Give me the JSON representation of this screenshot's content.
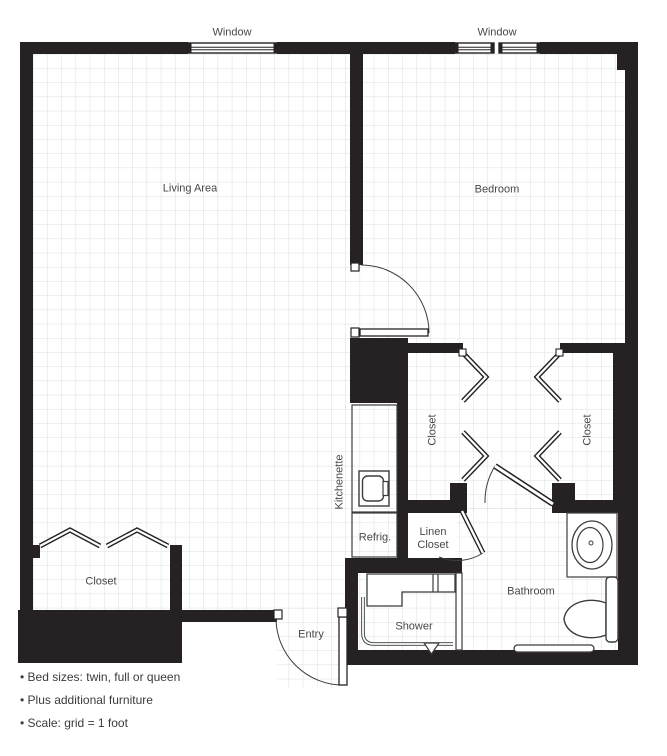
{
  "floor_plan": {
    "windows": {
      "living": "Window",
      "bedroom": "Window"
    },
    "rooms": {
      "living_area": "Living Area",
      "bedroom": "Bedroom",
      "bathroom": "Bathroom",
      "shower": "Shower",
      "entry": "Entry",
      "kitchenette": "Kitchenette",
      "refrigerator": "Refrig.",
      "linen_closet": "Linen Closet",
      "bedroom_closet_left": "Closet",
      "bedroom_closet_right": "Closet",
      "living_closet": "Closet"
    },
    "notes": [
      "• Bed sizes: twin, full or queen",
      "• Plus additional furniture",
      "• Scale: grid = 1 foot"
    ],
    "colors": {
      "wall": "#262223",
      "grid_line": "#d9e0de",
      "door_line": "#3c3c3e",
      "text": "#48484a"
    }
  }
}
